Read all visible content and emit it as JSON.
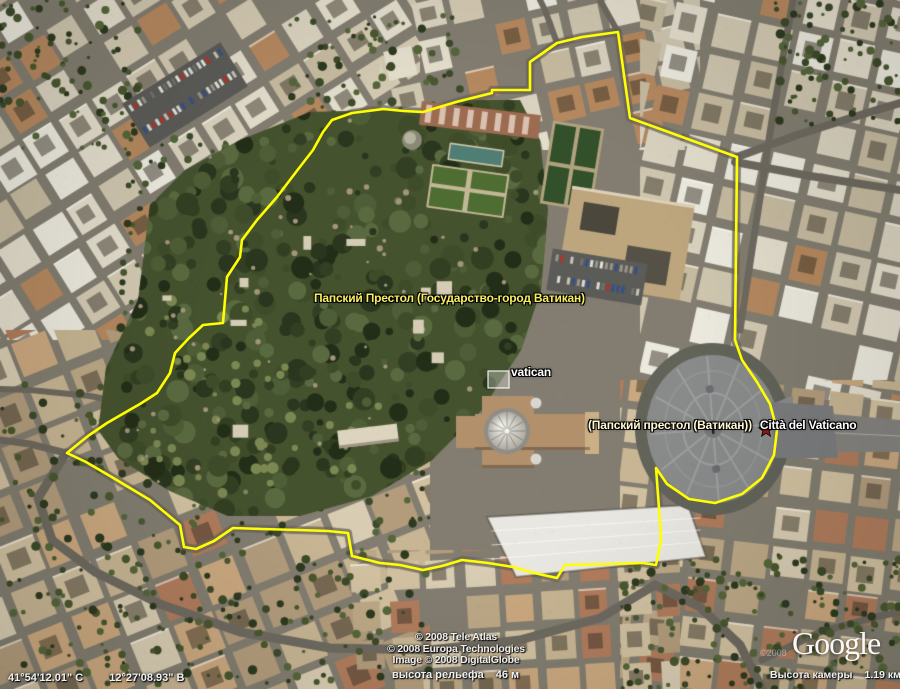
{
  "colors": {
    "border_yellow": "#ffff00",
    "label_yellow": "#f7ee62",
    "label_cream": "#fff8d2",
    "label_white": "#ffffff",
    "star_red": "#8e1a1a"
  },
  "placemarks": {
    "holy_see_full": "Папский Престол (Государство-город Ватикан)",
    "vatican_photo": "vatican",
    "holy_see_short": "(Папский престол (Ватикан))",
    "citta_del_vaticano": "Città del Vaticano"
  },
  "attribution": {
    "tele_atlas": "© 2008 Tele Atlas",
    "europa": "© 2008 Europa Technologies",
    "digitalglobe": "Image © 2008 DigitalGlobe",
    "watermark_year": "©2008",
    "logo": "Google"
  },
  "status": {
    "latitude": "41°54'12.01\" С",
    "longitude": "12°27'08.93\" В",
    "elevation_label": "высота рельефа",
    "elevation_value": "46 м",
    "camera_label": "Высота камеры",
    "camera_value": "1.19 км"
  }
}
